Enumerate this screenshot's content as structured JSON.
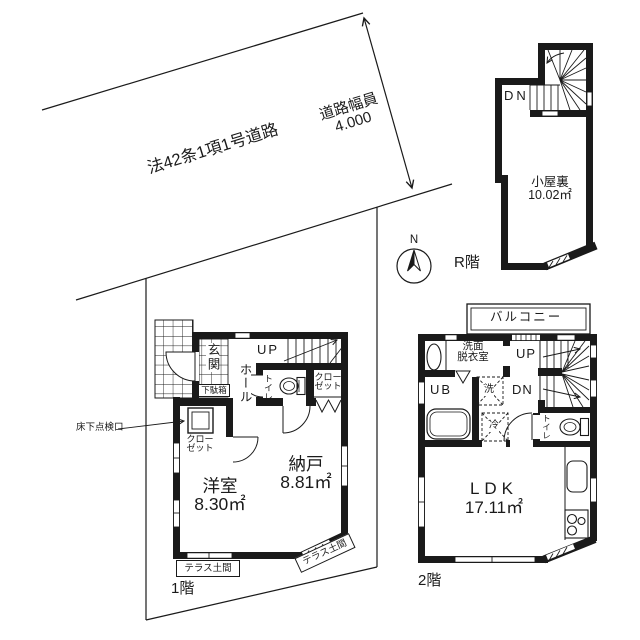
{
  "colors": {
    "ink": "#1a1a1a",
    "bg": "#ffffff"
  },
  "road": {
    "law": "法42条1項1号道路",
    "width_label": "道路幅員",
    "width_value": "4.000"
  },
  "compass": {
    "north": "N"
  },
  "roof_floor": {
    "dn": "DN",
    "room": "小屋裏",
    "area": "10.02㎡",
    "label": "R階"
  },
  "floor1": {
    "up": "UP",
    "entrance": "玄関",
    "shoe_box": "下駄箱",
    "hall": "ホール",
    "toilet": "トイレ",
    "closet_a_line1": "クロー",
    "closet_a_line2": "ゼット",
    "closet_b_line1": "クロー",
    "closet_b_line2": "ゼット",
    "inspection": "床下点検口",
    "room1": "洋室",
    "room1_area": "8.30㎡",
    "room2": "納戸",
    "room2_area": "8.81㎡",
    "terrace_left": "テラス土間",
    "terrace_right": "テラス土間",
    "label": "1階"
  },
  "floor2": {
    "balcony": "バルコニー",
    "washroom_line1": "洗面",
    "washroom_line2": "脱衣室",
    "bath": "UB",
    "washer": "洗",
    "fridge": "冷",
    "up": "UP",
    "dn": "DN",
    "toilet": "トイレ",
    "room": "LDK",
    "room_area": "17.11㎡",
    "label": "2階"
  }
}
